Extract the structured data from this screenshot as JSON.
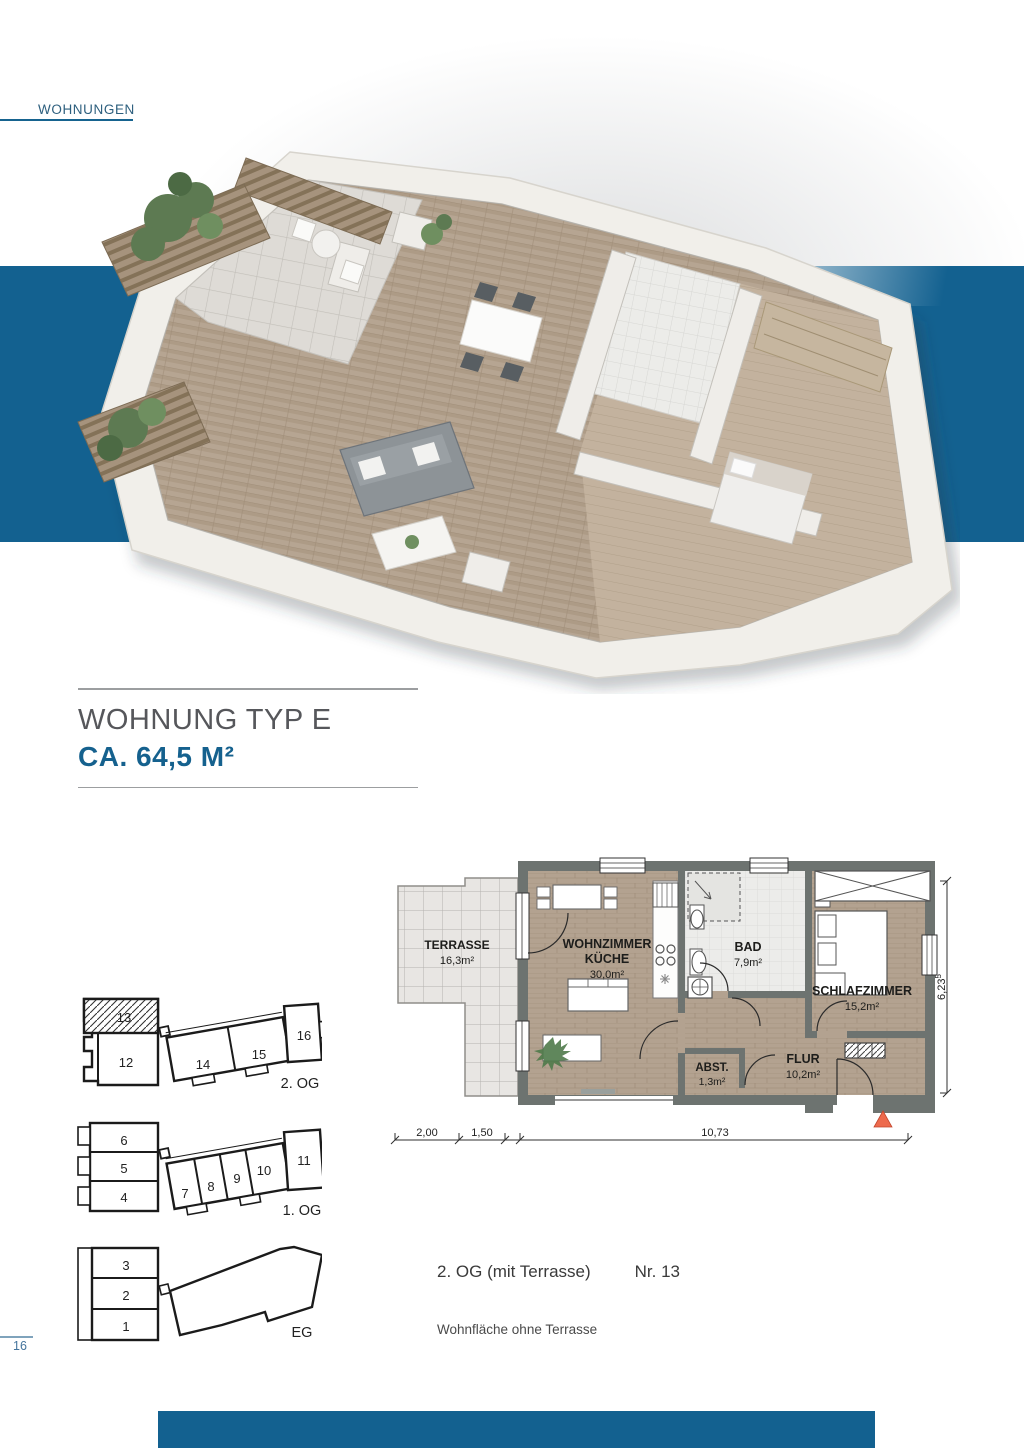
{
  "header": {
    "label": "WOHNUNGEN"
  },
  "title": {
    "line1": "WOHNUNG TYP E",
    "line2": "CA. 64,5 M²"
  },
  "floorplan": {
    "rooms": {
      "terrasse": {
        "name": "TERRASSE",
        "area": "16,3m²"
      },
      "wohnzimmer": {
        "name": "WOHNZIMMER",
        "name2": "KÜCHE",
        "area": "30,0m²"
      },
      "bad": {
        "name": "BAD",
        "area": "7,9m²"
      },
      "schlafzimmer": {
        "name": "SCHLAFZIMMER",
        "area": "15,2m²"
      },
      "abstellraum": {
        "name": "ABST.",
        "area": "1,3m²"
      },
      "flur": {
        "name": "FLUR",
        "area": "10,2m²"
      }
    },
    "dimensions": {
      "d1": "2,00",
      "d2": "1,50",
      "d3": "10,73",
      "height": "6,23",
      "height_sup": "5"
    }
  },
  "overview": {
    "floors": [
      {
        "label": "2. OG",
        "units": [
          "13",
          "12",
          "14",
          "15",
          "16"
        ],
        "highlighted_unit": "13"
      },
      {
        "label": "1. OG",
        "units": [
          "6",
          "5",
          "4",
          "7",
          "8",
          "9",
          "10",
          "11"
        ]
      },
      {
        "label": "EG",
        "units": [
          "3",
          "2",
          "1"
        ]
      }
    ]
  },
  "details": {
    "floor": "2. OG (mit Terrasse)",
    "unit": "Nr. 13",
    "note": "Wohnfläche ohne Terrasse"
  },
  "page": {
    "number": "16"
  },
  "colors": {
    "accent_blue": "#136190",
    "triangle_red": "#ED6A4D"
  }
}
